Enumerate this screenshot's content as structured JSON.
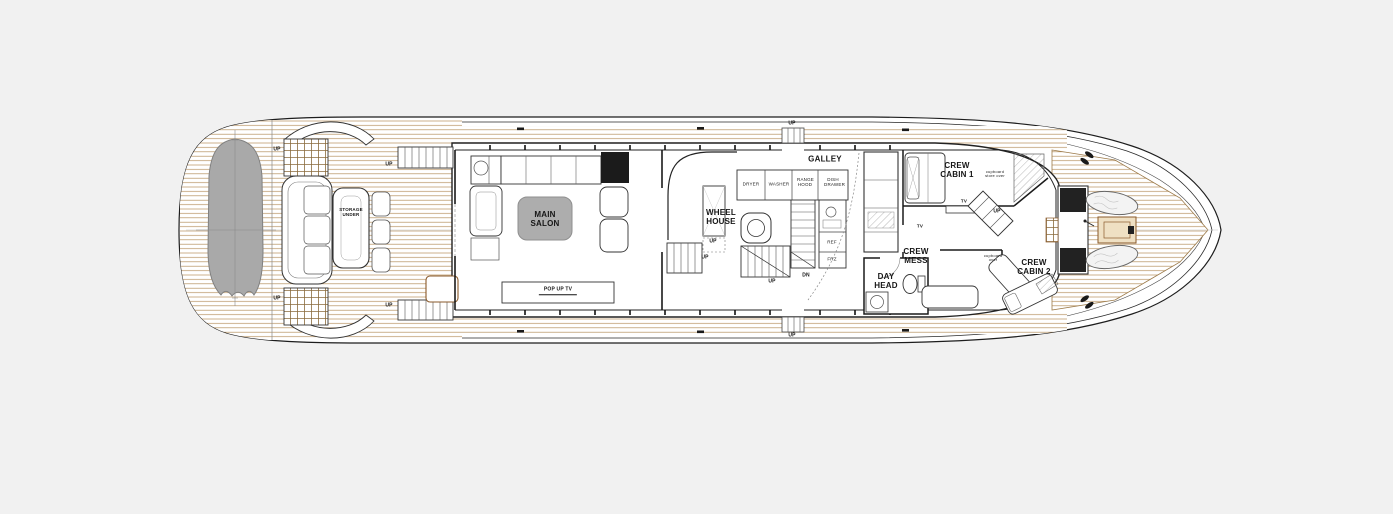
{
  "diagram": {
    "kind": "yacht-deck-general-arrangement-plan",
    "colors": {
      "background": "#f1f1f1",
      "hull_fill": "#ffffff",
      "line": "#1d1d1d",
      "teak_line": "#b5905e",
      "grate_line": "#8a6a3c",
      "tender_fill": "#a9a9a9",
      "coffee_table_fill": "#adadad",
      "dark_cabinet_fill": "#1b1b1b",
      "tan_accent": "#8a5a2b"
    },
    "rooms": {
      "main_salon": "MAIN SALON",
      "wheel_house": "WHEEL HOUSE",
      "galley": "GALLEY",
      "crew_cabin_1": "CREW CABIN 1",
      "crew_cabin_2": "CREW CABIN 2",
      "crew_mess": "CREW MESS",
      "day_head": "DAY HEAD"
    },
    "features": {
      "pop_up_tv": "POP UP TV",
      "storage_under": "STORAGE UNDER",
      "tv": "TV",
      "cupboard_store_over": "cupboard store over",
      "cupboard_over": "cupboard over"
    },
    "appliances": {
      "dryer": "DRYER",
      "washer": "WASHER",
      "range_hood": "RANGE HOOD",
      "dish_drawer": "DISH DRAWER",
      "ref": "REF",
      "frz": "FRZ"
    },
    "stairs": {
      "up": "UP",
      "dn": "DN"
    }
  }
}
